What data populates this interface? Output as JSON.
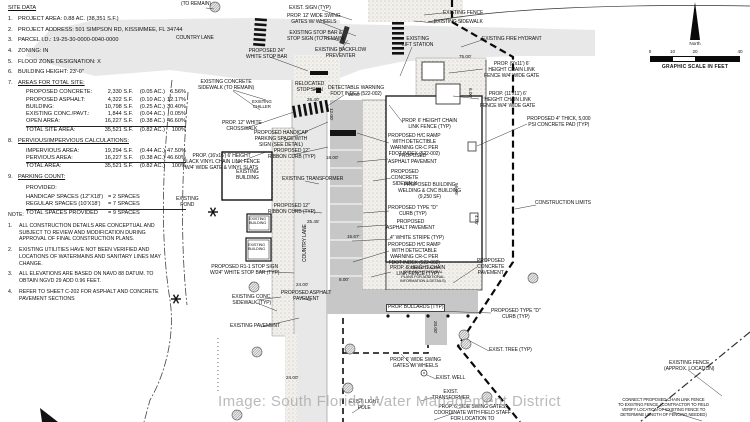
{
  "watermark": "Image: South Florida Water Management District",
  "compass": {
    "north_label": "North",
    "scale_ticks": [
      "0",
      "10",
      "20",
      "40"
    ],
    "scale_caption": "GRAPHIC SCALE IN FEET"
  },
  "site_data": {
    "title": "SITE DATA",
    "items": [
      {
        "n": "1.",
        "t": "PROJECT AREA: 0.88 AC. (38,351 S.F.)"
      },
      {
        "n": "2.",
        "t": "PROJECT ADDRESS: 501 SIMPSON RD, KISSIMMEE, FL 34744"
      },
      {
        "n": "3.",
        "t": "PARCEL I.D.: 19-25-30-0000-0040-0000"
      },
      {
        "n": "4.",
        "t": "ZONING: IN"
      },
      {
        "n": "5.",
        "t": "FLOOD ZONE DESIGNATION: X"
      },
      {
        "n": "6.",
        "t": "BUILDING HEIGHT: 23'-0\""
      },
      {
        "n": "7.",
        "t": "AREAS FOR TOTAL SITE:",
        "u": true,
        "rows": [
          {
            "c": [
              "PROPOSED CONCRETE:",
              "2,330 S.F.",
              "(0.05 AC.)",
              "6.56%"
            ]
          },
          {
            "c": [
              "PROPOSED ASPHALT:",
              "4,322 S.F.",
              "(0.10 AC.)",
              "12.17%"
            ]
          },
          {
            "c": [
              "BUILDING:",
              "10,798 S.F.",
              "(0.25 AC.)",
              "30.40%"
            ]
          },
          {
            "c": [
              "EXISTING CONC./PAVT.:",
              "1,844 S.F.",
              "(0.04 AC.)",
              "0.05%"
            ]
          },
          {
            "c": [
              "OPEN AREA:",
              "16,227 S.F.",
              "(0.38 AC.)",
              "46.60%"
            ],
            "u": true
          },
          {
            "c": [
              "TOTAL SITE AREA:",
              "35,521 S.F.",
              "(0.82 AC.)",
              "100%"
            ]
          }
        ]
      },
      {
        "n": "8.",
        "t": "PERVIOUS/IMPERVIOUS CALCULATIONS:",
        "u": true,
        "rows": [
          {
            "c": [
              "IMPERVIOUS AREA:",
              "19,294 S.F.",
              "(0.44 AC.)",
              "47.50%"
            ]
          },
          {
            "c": [
              "PERVIOUS AREA:",
              "16,227 S.F.",
              "(0.38 AC.)",
              "46.60%"
            ],
            "u": true
          },
          {
            "c": [
              "TOTAL AREA:",
              "35,521 S.F.",
              "(0.82 AC.)",
              "100%"
            ]
          }
        ]
      },
      {
        "n": "9.",
        "t": "PARKING COUNT:",
        "u": true,
        "pre": "PROVIDED:",
        "rows": [
          {
            "c": [
              "HANDICAP SPACES (12\"X18')",
              "= 2 SPACES"
            ]
          },
          {
            "c": [
              "REGULAR SPACES (10'X18')",
              "= 7 SPACES"
            ],
            "u": true
          },
          {
            "c": [
              "TOTAL SPACES PROVIDED",
              "= 9 SPACES"
            ]
          }
        ]
      }
    ]
  },
  "notes": {
    "title": "NOTE:",
    "items": [
      "ALL CONSTRUCTION DETAILS ARE CONCEPTUAL AND SUBJECT TO REVIEW AND MODIFICATION DURING APPROVAL OF FINAL CONSTRUCTION PLANS.",
      "EXISTING UTILITIES HAVE NOT BEEN VERIFIED AND LOCATIONS OF WATERMAINS AND SANITARY LINES MAY CHANGE.",
      "ALL ELEVATIONS ARE BASED ON NAVD 88 DATUM. TO OBTAIN NGVD 29 ADD 0.96 FEET.",
      "REFER TO SHEET C-202 FOR ASPHALT AND CONCRETE PAVEMENT SECTIONS"
    ]
  },
  "plan": {
    "labels": [
      {
        "t": "(TO REMAIN)",
        "x": 181,
        "y": 2
      },
      {
        "t": "EXIST. SIGN (TYP)",
        "x": 289,
        "y": 6
      },
      {
        "t": "PROP. 12' WIDE SWING\nGATES W/ WHEELS",
        "x": 287,
        "y": 14
      },
      {
        "t": "EXISTING STOP BAR &\nSTOP SIGN (TO REMAIN)",
        "x": 287,
        "y": 31
      },
      {
        "t": "PROPOSED 24\"\nWHITE STOP BAR",
        "x": 246,
        "y": 49
      },
      {
        "t": "EXISTING BACKFLOW\nPREVENTER",
        "x": 315,
        "y": 48
      },
      {
        "t": "COUNTRY LANE",
        "x": 176,
        "y": 36
      },
      {
        "t": "EXISTING CONCRETE\nSIDEWALK (TO REMAIN)",
        "x": 198,
        "y": 80
      },
      {
        "t": "RELOCATED\nSTOP SIGN",
        "x": 295,
        "y": 82
      },
      {
        "t": "DETECTABLE WARNING\nFDOT INDEX (522-002)",
        "x": 328,
        "y": 86
      },
      {
        "t": "EXISTING\nCHILLER",
        "x": 252,
        "y": 99,
        "s": 4.4
      },
      {
        "t": "PROP. 12\" WHITE\nCROSSWALK",
        "x": 222,
        "y": 121
      },
      {
        "t": "EXISTING FENCE",
        "x": 443,
        "y": 11
      },
      {
        "t": "EXISTING SIDEWALK",
        "x": 434,
        "y": 20
      },
      {
        "t": "EXISTING\nLIFT STATION",
        "x": 402,
        "y": 37
      },
      {
        "t": "EXISTING FIRE HYDRANT",
        "x": 482,
        "y": 37
      },
      {
        "t": "PROP. (9'x11') 6'\nHEIGHT CHAIN LINK\nFENCE W/4' WIDE GATE",
        "x": 484,
        "y": 62
      },
      {
        "t": "PROP. (11'x11') 6'\nHEIGHT CHAIN LINK\nFENCE W/4' WIDE GATE",
        "x": 480,
        "y": 92
      },
      {
        "t": "PROPOSED 4\" THICK, 5,000\nPSI CONCRETE PAD (TYP)",
        "x": 527,
        "y": 117
      },
      {
        "t": "PROP. 6' HEIGHT CHAIN\nLINK FENCE (TYP)",
        "x": 402,
        "y": 119
      },
      {
        "t": "PROPOSED H/C RAMP\nWITH DETECTIBLE\nWARNING CR-C PER\nFDOT INDEX (522-002)",
        "x": 388,
        "y": 134
      },
      {
        "t": "PROPOSED\nASPHALT PAVEMENT",
        "x": 388,
        "y": 154
      },
      {
        "t": "PROPOSED\nCONCRETE\nSIDEWALK",
        "x": 391,
        "y": 170
      },
      {
        "t": "PROPOSED BUILDING\nWELDING & CNC BUILDING\n(9,250 SF)",
        "x": 398,
        "y": 183
      },
      {
        "t": "PROPOSED HANDICAP\nPARKING SPACE WITH\nSIGN (SEE DETAIL)",
        "x": 254,
        "y": 131
      },
      {
        "t": "PROPOSED 12\"\nRIBBON CURB (TYP)",
        "x": 268,
        "y": 149
      },
      {
        "t": "PROP. (16'x16') 6' HEIGHT\nBLACK VINYL CHAIN LINK FENCE\nW/4' WIDE GATE & VINYL SLATS",
        "x": 183,
        "y": 154
      },
      {
        "t": "EXISTING\nBUILDING",
        "x": 236,
        "y": 170
      },
      {
        "t": "EXISTING TRANSFORMER",
        "x": 282,
        "y": 177
      },
      {
        "t": "EXISTING\nPOND",
        "x": 176,
        "y": 197
      },
      {
        "t": "PROPOSED 12\"\nRIBBON CURB (TYP)",
        "x": 268,
        "y": 204
      },
      {
        "t": "EXISTING\nBUILDING",
        "x": 249,
        "y": 217,
        "s": 3.8
      },
      {
        "t": "EXISTING\nBUILDING",
        "x": 248,
        "y": 243,
        "s": 3.8
      },
      {
        "t": "CONSTRUCTION LIMITS",
        "x": 535,
        "y": 201
      },
      {
        "t": "PROPOSED TYPE \"D\"\nCURB (TYP)",
        "x": 388,
        "y": 206
      },
      {
        "t": "PROPOSED\nASPHALT PAVEMENT",
        "x": 386,
        "y": 220
      },
      {
        "t": "4\" WHITE STRIPE (TYP)",
        "x": 390,
        "y": 236
      },
      {
        "t": "PROPOSED H/C RAMP\nWITH DETECTABLE\nWARNING CR-C PER\nFDOT INDEX (522-002)",
        "x": 388,
        "y": 243
      },
      {
        "t": "PROP. 6' HEIGHT CHAIN\nLINK FENCE (TYP)",
        "x": 390,
        "y": 266
      },
      {
        "t": "PROPOSED\nCONCRETE\nPAVEMENT",
        "x": 477,
        "y": 259
      },
      {
        "t": "COVERED CANOPY\n(SEE ARCHITECTURAL\nPLANS FOR ADDITIONAL\nINFORMATION & DETAILS)",
        "x": 400,
        "y": 266,
        "s": 3.8
      },
      {
        "t": "PROP. BOLLARDS (TYP)",
        "x": 387,
        "y": 305,
        "bg": true
      },
      {
        "t": "PROPOSED R1-1 STOP SIGN\nW/24\" WHITE STOP BAR (TYP)",
        "x": 210,
        "y": 265
      },
      {
        "t": "EXISTING CONC.\nSIDEWALK (TYP)",
        "x": 232,
        "y": 295
      },
      {
        "t": "PROPOSED ASPHALT\nPAVEMENT",
        "x": 281,
        "y": 291
      },
      {
        "t": "EXISTING PAVEMENT",
        "x": 230,
        "y": 324
      },
      {
        "t": "PROPOSED TYPE \"D\"\nCURB (TYP)",
        "x": 491,
        "y": 309
      },
      {
        "t": "EXIST. TREE (TYP)",
        "x": 489,
        "y": 348
      },
      {
        "t": "PROP. 6' WIDE SWING\nGATES W/ WHEELS",
        "x": 390,
        "y": 358
      },
      {
        "t": "EXIST. WELL",
        "x": 436,
        "y": 376
      },
      {
        "t": "EXIST.\nTRANSFORMER",
        "x": 432,
        "y": 390
      },
      {
        "t": "EXIST. LIGHT\nPOLE",
        "x": 349,
        "y": 400
      },
      {
        "t": "PROP. 6' SIDE SWING GATES,\nCOORDINATE WITH FIELD STAFF\nFOR LOCATION TO",
        "x": 434,
        "y": 405
      },
      {
        "t": "EXISTING FENCE\n(APPROX. LOCATION)",
        "x": 664,
        "y": 361
      },
      {
        "t": "CONNECT PROPOSED CHAIN LINK FENCE\nTO EXISTING FENCE. (CONTRACTOR TO FIELD\nVERIFY LOCATION OF EXISTING FENCE TO\nDETERMINE LENGTH OF FENCING NEEDED)",
        "x": 618,
        "y": 398,
        "s": 4.2
      },
      {
        "t": "COUNTRY LANE",
        "x": 303,
        "y": 262,
        "r": -90
      }
    ],
    "dims": [
      {
        "t": "75.00'",
        "x": 459,
        "y": 54
      },
      {
        "t": "26.40'",
        "x": 307,
        "y": 97
      },
      {
        "t": "15.00'",
        "x": 348,
        "y": 92
      },
      {
        "t": "12.00'",
        "x": 334,
        "y": 108,
        "r": 90
      },
      {
        "t": "18.00'",
        "x": 326,
        "y": 155
      },
      {
        "t": "25.45'",
        "x": 307,
        "y": 219
      },
      {
        "t": "15.67'",
        "x": 347,
        "y": 234
      },
      {
        "t": "8.00'",
        "x": 339,
        "y": 277
      },
      {
        "t": "24.00'",
        "x": 296,
        "y": 282
      },
      {
        "t": "24.00'",
        "x": 286,
        "y": 375
      },
      {
        "t": "56.05'",
        "x": 459,
        "y": 183,
        "r": 90
      },
      {
        "t": "20.00'",
        "x": 438,
        "y": 321,
        "r": 90
      },
      {
        "t": "6.00'",
        "x": 473,
        "y": 88,
        "r": 90
      },
      {
        "t": "4.00'",
        "x": 479,
        "y": 215,
        "r": 90
      }
    ]
  }
}
